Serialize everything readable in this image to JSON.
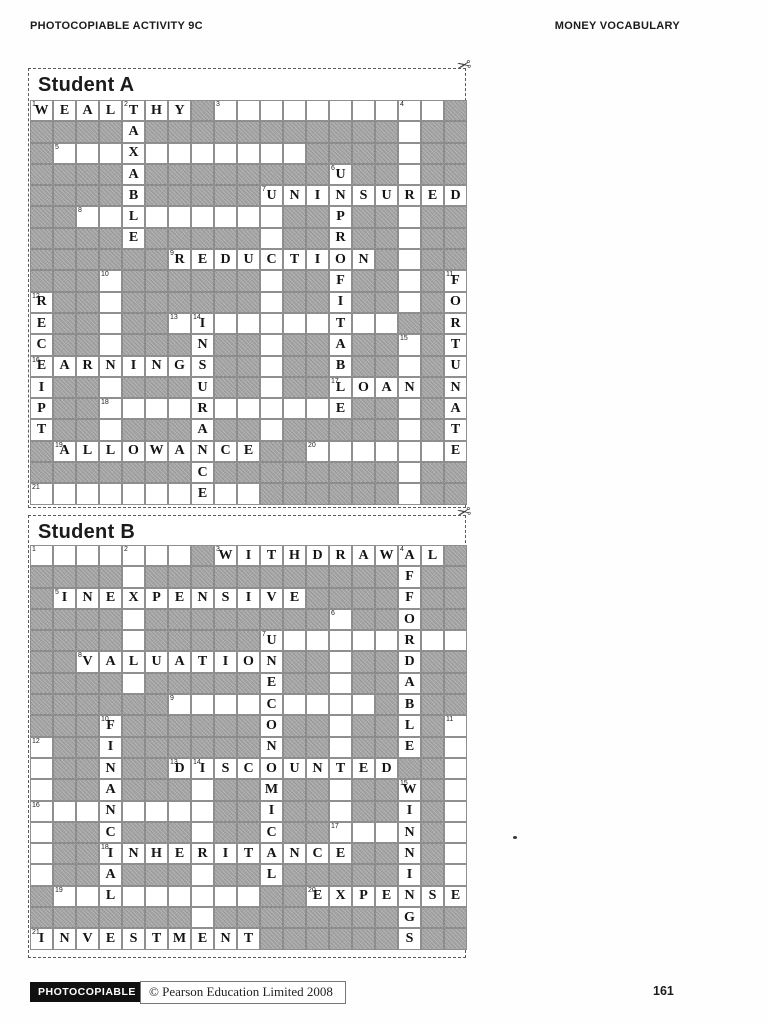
{
  "header": {
    "left": "PHOTOCOPIABLE ACTIVITY 9C",
    "right": "MONEY VOCABULARY"
  },
  "colors": {
    "block_fill": "#a7a7a7",
    "cell_border": "#8f8f8f",
    "dash_border": "#5a5a5a",
    "badge_bg": "#101010"
  },
  "sections": [
    {
      "id": "student-a",
      "title": "Student A",
      "scissors_icon": "✂",
      "grid": [
        [
          "1W",
          "E",
          "A",
          "L",
          "2T",
          "H",
          "Y",
          "#",
          "3",
          ".",
          ".",
          ".",
          ".",
          ".",
          ".",
          ".",
          "4",
          ".",
          "#"
        ],
        [
          "#",
          "#",
          "#",
          "#",
          "A",
          "#",
          "#",
          "#",
          "#",
          "#",
          "#",
          "#",
          "#",
          "#",
          "#",
          "#",
          ".",
          "#",
          "#"
        ],
        [
          "#",
          "5",
          ".",
          ".",
          "X",
          ".",
          ".",
          ".",
          ".",
          ".",
          ".",
          ".",
          "#",
          "#",
          "#",
          "#",
          ".",
          "#",
          "#"
        ],
        [
          "#",
          "#",
          "#",
          "#",
          "A",
          "#",
          "#",
          "#",
          "#",
          "#",
          "#",
          "#",
          "#",
          "6U",
          "#",
          "#",
          ".",
          "#",
          "#"
        ],
        [
          "#",
          "#",
          "#",
          "#",
          "B",
          "#",
          "#",
          "#",
          "#",
          "#",
          "7U",
          "N",
          "I",
          "N",
          "S",
          "U",
          "R",
          "E",
          "D"
        ],
        [
          "#",
          "#",
          "8",
          ".",
          "L",
          ".",
          ".",
          ".",
          ".",
          ".",
          ".",
          "#",
          "#",
          "P",
          "#",
          "#",
          ".",
          "#",
          "#"
        ],
        [
          "#",
          "#",
          "#",
          "#",
          "E",
          "#",
          "#",
          "#",
          "#",
          "#",
          ".",
          "#",
          "#",
          "R",
          "#",
          "#",
          ".",
          "#",
          "#"
        ],
        [
          "#",
          "#",
          "#",
          "#",
          "#",
          "#",
          "9R",
          "E",
          "D",
          "U",
          "C",
          "T",
          "I",
          "O",
          "N",
          "#",
          ".",
          "#",
          "#"
        ],
        [
          "#",
          "#",
          "#",
          "10",
          "#",
          "#",
          "#",
          "#",
          "#",
          "#",
          ".",
          "#",
          "#",
          "F",
          "#",
          "#",
          ".",
          "#",
          "11F"
        ],
        [
          "12R",
          "#",
          "#",
          ".",
          "#",
          "#",
          "#",
          "#",
          "#",
          "#",
          ".",
          "#",
          "#",
          "I",
          "#",
          "#",
          ".",
          "#",
          "O"
        ],
        [
          "E",
          "#",
          "#",
          ".",
          "#",
          "#",
          "13",
          "14I",
          ".",
          ".",
          ".",
          ".",
          ".",
          "T",
          ".",
          ".",
          "#",
          "#",
          "R"
        ],
        [
          "C",
          "#",
          "#",
          ".",
          "#",
          "#",
          "#",
          "N",
          "#",
          "#",
          ".",
          "#",
          "#",
          "A",
          "#",
          "#",
          "15",
          "#",
          "T"
        ],
        [
          "16E",
          "A",
          "R",
          "N",
          "I",
          "N",
          "G",
          "S",
          "#",
          "#",
          ".",
          "#",
          "#",
          "B",
          "#",
          "#",
          ".",
          "#",
          "U"
        ],
        [
          "I",
          "#",
          "#",
          ".",
          "#",
          "#",
          "#",
          "U",
          "#",
          "#",
          ".",
          "#",
          "#",
          "17L",
          "O",
          "A",
          "N",
          "#",
          "N"
        ],
        [
          "P",
          "#",
          "#",
          "18",
          ".",
          ".",
          ".",
          "R",
          ".",
          ".",
          ".",
          ".",
          ".",
          "E",
          "#",
          "#",
          ".",
          "#",
          "A"
        ],
        [
          "T",
          "#",
          "#",
          ".",
          "#",
          "#",
          "#",
          "A",
          "#",
          "#",
          ".",
          "#",
          "#",
          "#",
          "#",
          "#",
          ".",
          "#",
          "T"
        ],
        [
          "#",
          "19A",
          "L",
          "L",
          "O",
          "W",
          "A",
          "N",
          "C",
          "E",
          "#",
          "#",
          "20",
          ".",
          ".",
          ".",
          ".",
          ".",
          "E"
        ],
        [
          "#",
          "#",
          "#",
          "#",
          "#",
          "#",
          "#",
          "C",
          "#",
          "#",
          "#",
          "#",
          "#",
          "#",
          "#",
          "#",
          ".",
          "#",
          "#"
        ],
        [
          "21",
          ".",
          ".",
          ".",
          ".",
          ".",
          ".",
          "E",
          ".",
          ".",
          "#",
          "#",
          "#",
          "#",
          "#",
          "#",
          ".",
          "#",
          "#"
        ]
      ]
    },
    {
      "id": "student-b",
      "title": "Student B",
      "scissors_icon": "✂",
      "grid": [
        [
          "1",
          ".",
          ".",
          ".",
          "2",
          ".",
          ".",
          "#",
          "3W",
          "I",
          "T",
          "H",
          "D",
          "R",
          "A",
          "W",
          "4A",
          "L",
          "#"
        ],
        [
          "#",
          "#",
          "#",
          "#",
          ".",
          "#",
          "#",
          "#",
          "#",
          "#",
          "#",
          "#",
          "#",
          "#",
          "#",
          "#",
          "F",
          "#",
          "#"
        ],
        [
          "#",
          "5I",
          "N",
          "E",
          "X",
          "P",
          "E",
          "N",
          "S",
          "I",
          "V",
          "E",
          "#",
          "#",
          "#",
          "#",
          "F",
          "#",
          "#"
        ],
        [
          "#",
          "#",
          "#",
          "#",
          ".",
          "#",
          "#",
          "#",
          "#",
          "#",
          "#",
          "#",
          "#",
          "6",
          "#",
          "#",
          "O",
          "#",
          "#"
        ],
        [
          "#",
          "#",
          "#",
          "#",
          ".",
          "#",
          "#",
          "#",
          "#",
          "#",
          "7U",
          ".",
          ".",
          ".",
          ".",
          ".",
          "R",
          ".",
          "."
        ],
        [
          "#",
          "#",
          "8V",
          "A",
          "L",
          "U",
          "A",
          "T",
          "I",
          "O",
          "N",
          "#",
          "#",
          ".",
          "#",
          "#",
          "D",
          "#",
          "#"
        ],
        [
          "#",
          "#",
          "#",
          "#",
          ".",
          "#",
          "#",
          "#",
          "#",
          "#",
          "E",
          "#",
          "#",
          ".",
          "#",
          "#",
          "A",
          "#",
          "#"
        ],
        [
          "#",
          "#",
          "#",
          "#",
          "#",
          "#",
          "9",
          ".",
          ".",
          ".",
          "C",
          ".",
          ".",
          ".",
          ".",
          "#",
          "B",
          "#",
          "#"
        ],
        [
          "#",
          "#",
          "#",
          "10F",
          "#",
          "#",
          "#",
          "#",
          "#",
          "#",
          "O",
          "#",
          "#",
          ".",
          "#",
          "#",
          "L",
          "#",
          "11"
        ],
        [
          "12",
          "#",
          "#",
          "I",
          "#",
          "#",
          "#",
          "#",
          "#",
          "#",
          "N",
          "#",
          "#",
          ".",
          "#",
          "#",
          "E",
          "#",
          "."
        ],
        [
          ".",
          "#",
          "#",
          "N",
          "#",
          "#",
          "13D",
          "14I",
          "S",
          "C",
          "O",
          "U",
          "N",
          "T",
          "E",
          "D",
          "#",
          "#",
          "."
        ],
        [
          ".",
          "#",
          "#",
          "A",
          "#",
          "#",
          "#",
          ".",
          "#",
          "#",
          "M",
          "#",
          "#",
          ".",
          "#",
          "#",
          "15W",
          "#",
          "."
        ],
        [
          "16",
          ".",
          ".",
          "N",
          ".",
          ".",
          ".",
          ".",
          "#",
          "#",
          "I",
          "#",
          "#",
          ".",
          "#",
          "#",
          "I",
          "#",
          "."
        ],
        [
          ".",
          "#",
          "#",
          "C",
          "#",
          "#",
          "#",
          ".",
          "#",
          "#",
          "C",
          "#",
          "#",
          "17",
          ".",
          ".",
          "N",
          "#",
          "."
        ],
        [
          ".",
          "#",
          "#",
          "18I",
          "N",
          "H",
          "E",
          "R",
          "I",
          "T",
          "A",
          "N",
          "C",
          "E",
          "#",
          "#",
          "N",
          "#",
          "."
        ],
        [
          ".",
          "#",
          "#",
          "A",
          "#",
          "#",
          "#",
          ".",
          "#",
          "#",
          "L",
          "#",
          "#",
          "#",
          "#",
          "#",
          "I",
          "#",
          "."
        ],
        [
          "#",
          "19",
          ".",
          "L",
          ".",
          ".",
          ".",
          ".",
          ".",
          ".",
          "#",
          "#",
          "20E",
          "X",
          "P",
          "E",
          "N",
          "S",
          "E"
        ],
        [
          "#",
          "#",
          "#",
          "#",
          "#",
          "#",
          "#",
          ".",
          "#",
          "#",
          "#",
          "#",
          "#",
          "#",
          "#",
          "#",
          "G",
          "#",
          "#"
        ],
        [
          "21I",
          "N",
          "V",
          "E",
          "S",
          "T",
          "M",
          "E",
          "N",
          "T",
          "#",
          "#",
          "#",
          "#",
          "#",
          "#",
          "S",
          "#",
          "#"
        ]
      ]
    }
  ],
  "footer": {
    "badge": "PHOTOCOPIABLE",
    "copyright": "© Pearson Education Limited 2008",
    "page_number": "161"
  }
}
